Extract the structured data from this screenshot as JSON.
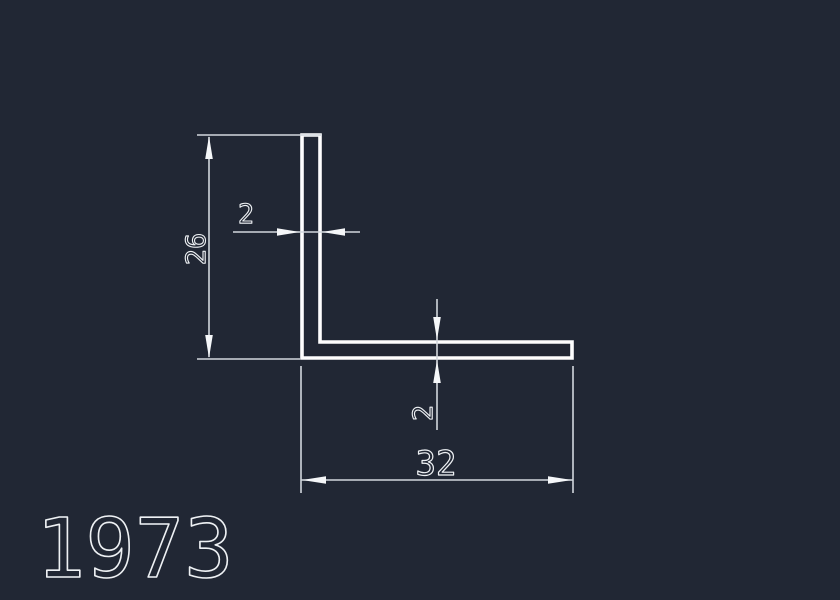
{
  "drawing": {
    "part_number": "1973",
    "dimensions": {
      "height_label": "26",
      "width_label": "32",
      "vertical_wall_thickness_label": "2",
      "horizontal_wall_thickness_label": "2"
    }
  },
  "colors": {
    "background": "#212734",
    "profile_line": "#fefefe",
    "dimension_line": "#d2d7dd",
    "arrow": "#f5f7f9",
    "text": "#eef1f4"
  }
}
